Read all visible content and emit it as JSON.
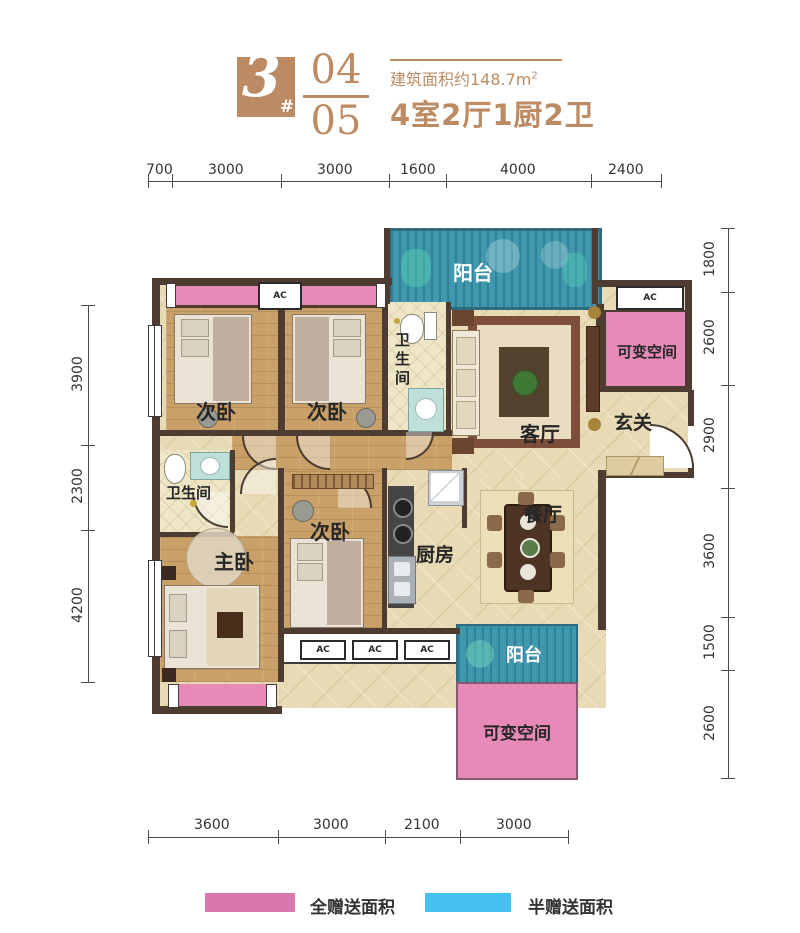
{
  "header": {
    "block_number": "3",
    "hash": "#",
    "unit_a": "04",
    "unit_b": "05",
    "area_note": "建筑面积约148.7m",
    "area_sup": "2",
    "layout_summary": "4室2厅1厨2卫"
  },
  "dimensions": {
    "top": [
      "700",
      "3000",
      "3000",
      "1600",
      "4000",
      "2400"
    ],
    "left": [
      "3900",
      "2300",
      "4200"
    ],
    "right": [
      "1800",
      "2600",
      "2900",
      "3600",
      "1500",
      "2600"
    ],
    "bottom": [
      "3600",
      "3000",
      "2100",
      "3000"
    ]
  },
  "rooms": {
    "balcony": "阳台",
    "bedroom": "次卧",
    "master_bedroom": "主卧",
    "bathroom": "卫生间",
    "living_room": "客厅",
    "dining_room": "餐厅",
    "kitchen": "厨房",
    "entry": "玄关",
    "flex_space": "可变空间",
    "ac_unit": "AC"
  },
  "legend": {
    "full_gift": {
      "label": "全赠送面积",
      "color": "#d878ac"
    },
    "half_gift": {
      "label": "半赠送面积",
      "color": "#45c1ef"
    }
  },
  "colors": {
    "accent": "#bd8b63",
    "wall": "#4e3b31",
    "gift_full_pink": "#e78ab8",
    "gift_half_teal": "#3f98ae"
  }
}
